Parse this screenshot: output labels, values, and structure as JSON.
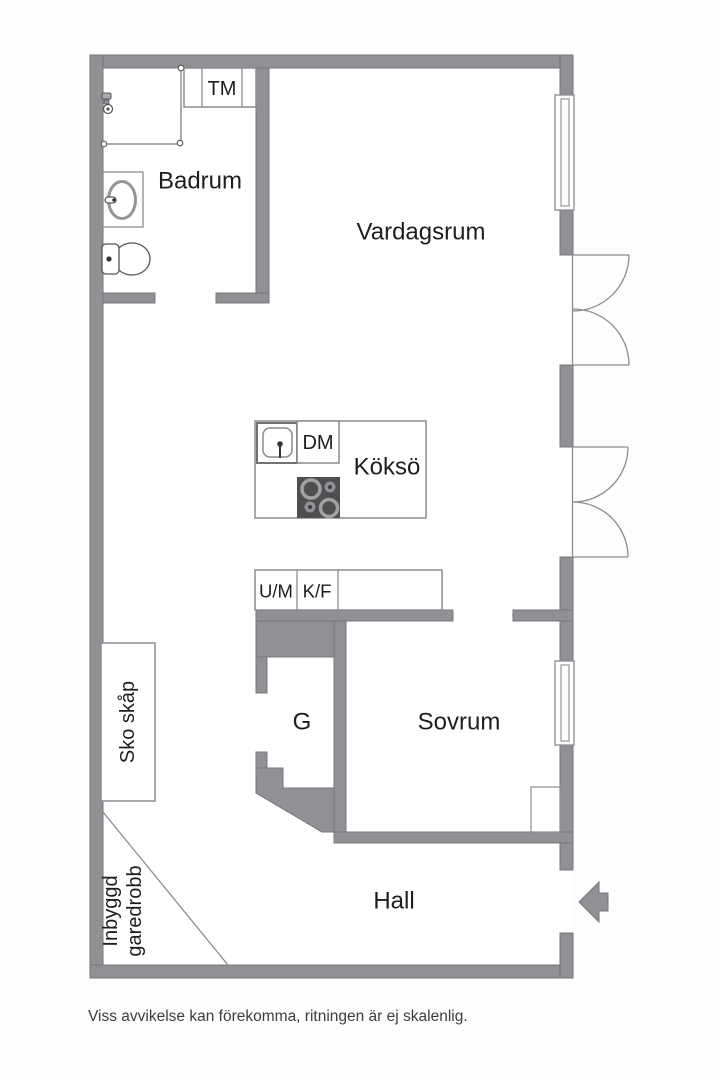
{
  "labels": {
    "badrum": "Badrum",
    "tm": "TM",
    "vardagsrum": "Vardagsrum",
    "dm": "DM",
    "kokso": "Köksö",
    "um": "U/M",
    "kf": "K/F",
    "sko_skap": "Sko skåp",
    "g": "G",
    "sovrum": "Sovrum",
    "hall": "Hall",
    "inbyggd_line1": "Inbyggd",
    "inbyggd_line2": "garedrobb"
  },
  "footer": {
    "disclaimer": "Viss avvikelse kan förekomma, ritningen är ej skalenlig."
  },
  "icons": {
    "entrance_arrow": "arrow-left-icon",
    "shower": "shower-icon",
    "toilet": "toilet-icon",
    "washbasin": "washbasin-icon",
    "kitchen_sink": "sink-icon",
    "stove": "stove-icon"
  },
  "colors": {
    "wall": "#8f9194",
    "line": "#8a8c8f",
    "stove_dark": "#4d4f50",
    "burner_ring": "#9fa1a3",
    "label_text": "#1d1d1e",
    "footer_text": "#3b3d3e",
    "floor": "#ffffff"
  }
}
